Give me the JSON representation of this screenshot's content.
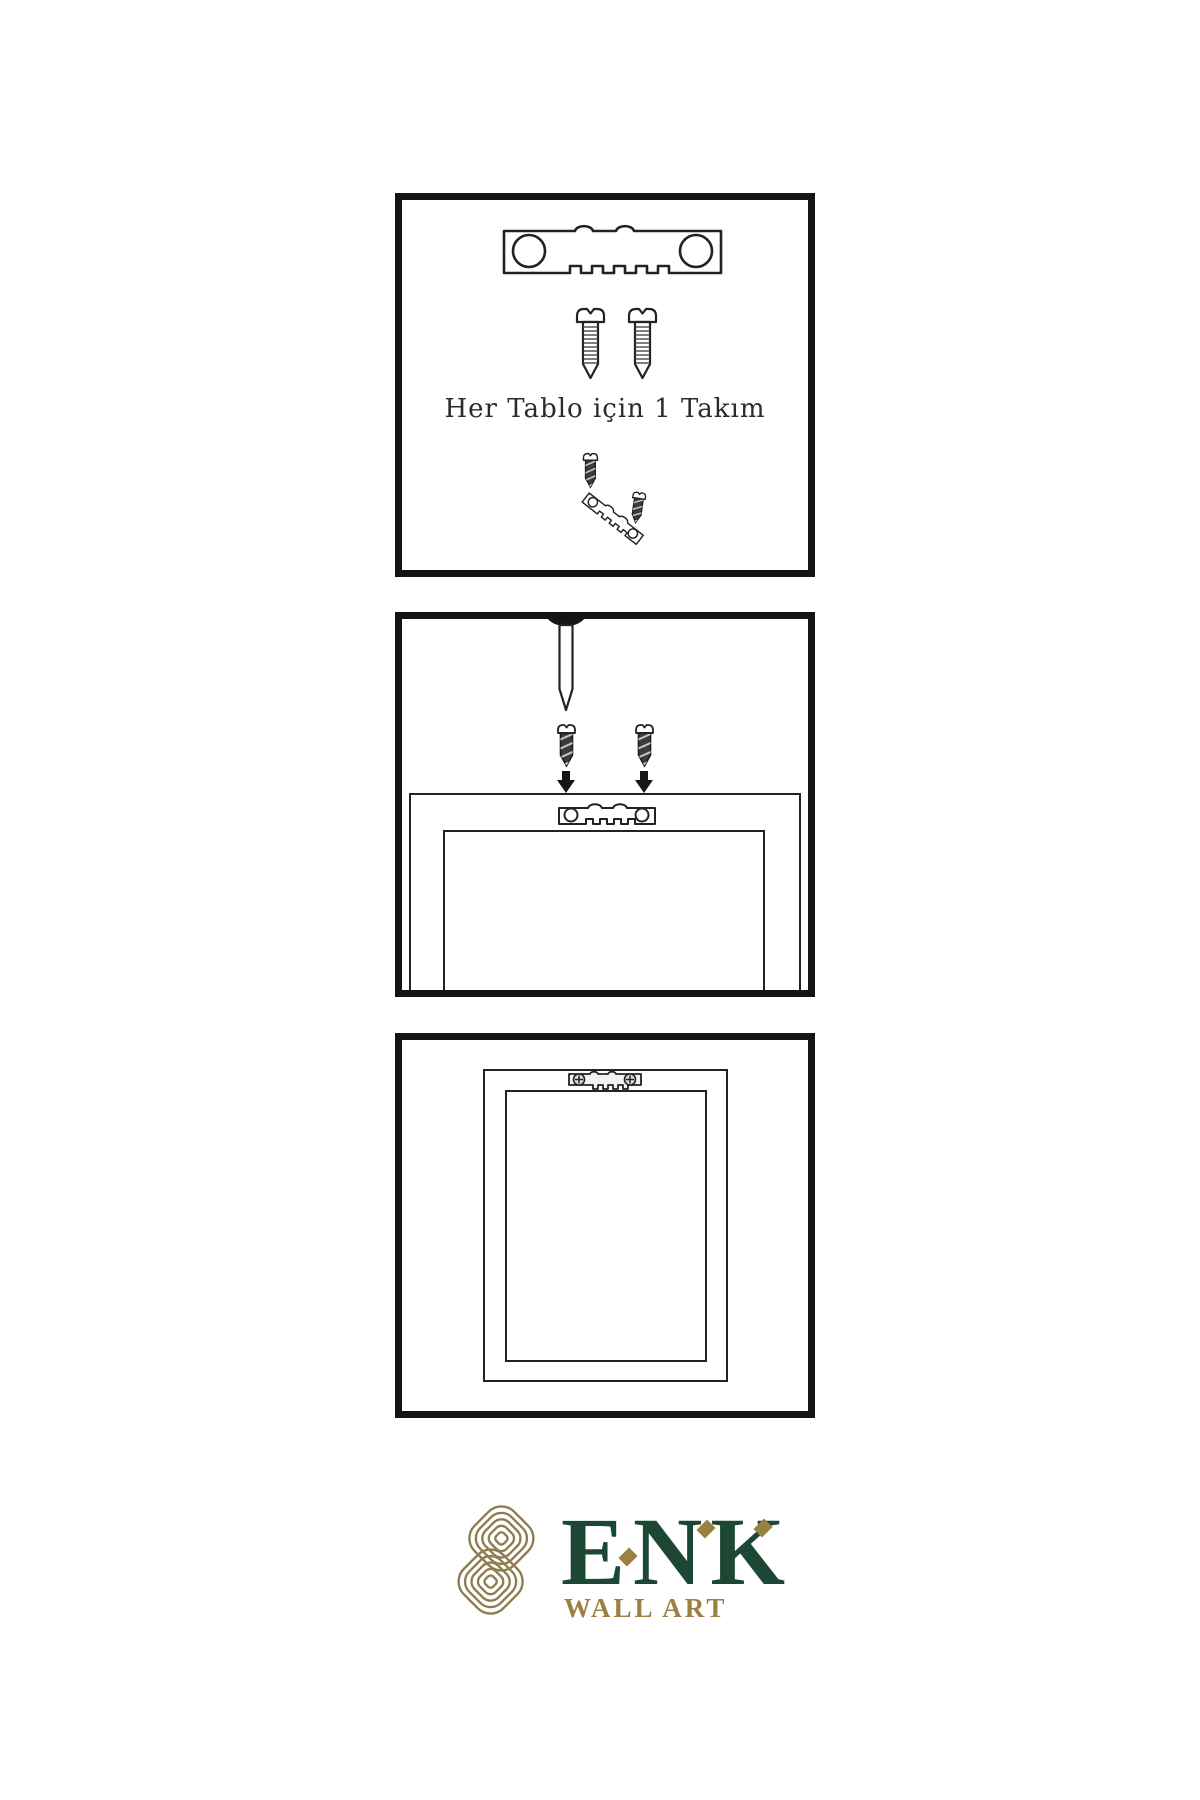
{
  "colors": {
    "background": "#ffffff",
    "line_art": "#222222",
    "panel_border": "#141414",
    "screw_dark_fill": "#3b3b3b",
    "nail_head": "#161616",
    "brand_green": "#1c4734",
    "brand_gold": "#9a8143",
    "knot_gold": "#8d7c4e"
  },
  "panels": [
    {
      "name": "kit-contents",
      "caption": "Her Tablo için 1 Takım",
      "icons": [
        "sawtooth-hanger-icon",
        "screw-icon",
        "screw-icon",
        "screw-into-tilted-hanger-icon"
      ]
    },
    {
      "name": "attach-hanger-to-frame-back",
      "icons": [
        "wall-nail-icon",
        "dark-screw-icon",
        "down-arrow-icon",
        "dark-screw-icon",
        "down-arrow-icon",
        "sawtooth-hanger-icon",
        "frame-back-outline"
      ]
    },
    {
      "name": "frame-hung-on-wall",
      "icons": [
        "frame-front-outline",
        "mounted-sawtooth-hanger-icon"
      ]
    }
  ],
  "logo": {
    "symbol": "interlaced-knot-icon",
    "wordmark": "ENK",
    "subtitle": "WALL ART"
  }
}
